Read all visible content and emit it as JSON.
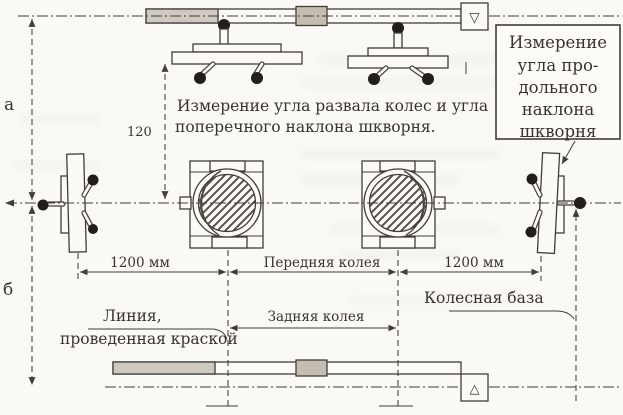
{
  "diagram": {
    "side_labels": {
      "a": "а",
      "b": "б"
    },
    "dimensions": {
      "vertical_offset": "120",
      "left_spacing": "1200 мм",
      "right_spacing": "1200 мм",
      "front_track": "Передняя колея",
      "rear_track": "Задняя колея",
      "wheelbase": "Колесная база"
    },
    "captions": {
      "camber_line1": "Измерение угла развала колес и угла",
      "camber_line2": "поперечного наклона шкворня.",
      "paint_line1": "Линия,",
      "paint_line2": "проведенная краской"
    },
    "callout": {
      "line1": "Измерение",
      "line2": "угла про-",
      "line3": "дольного",
      "line4": "наклона",
      "line5": "шкворня"
    },
    "datum_marks": {
      "top": "▽",
      "bottom": "△"
    },
    "colors": {
      "ink": "#423d37",
      "paper": "#fbfaf6",
      "shade": "#cdc7bd",
      "dot": "#221e1a"
    }
  }
}
